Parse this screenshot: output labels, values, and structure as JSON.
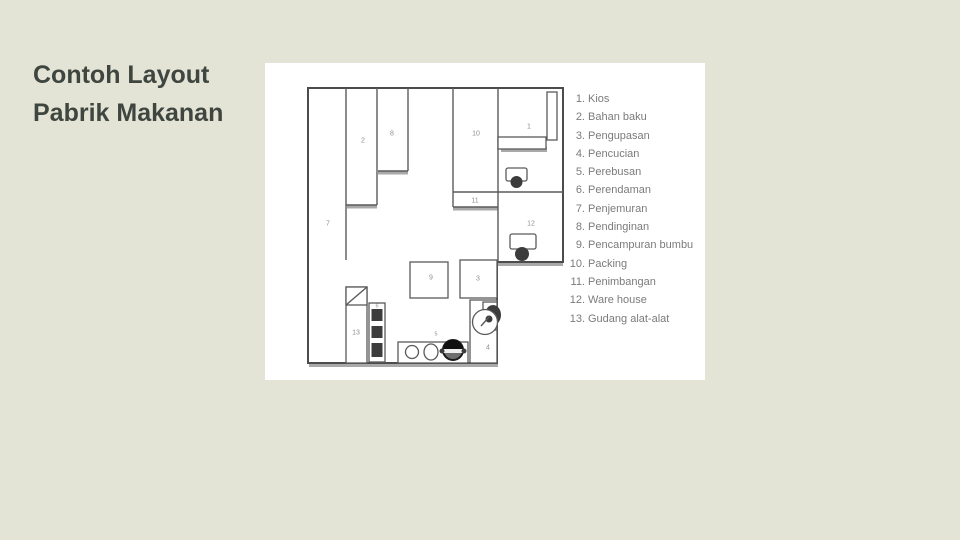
{
  "slide": {
    "title_line1": "Contoh Layout",
    "title_line2": "Pabrik Makanan"
  },
  "colors": {
    "background": "#e3e4d6",
    "panel": "#ffffff",
    "title_text": "#3e463f",
    "wall": "#4c4c4c",
    "wall_shadow": "#a9a9a9",
    "legend_text": "#7b7b7b",
    "room_label": "#8f8f8f",
    "equipment_dark": "#3c3c3c"
  },
  "plan": {
    "rooms": [
      {
        "num": "1",
        "name": "Kios"
      },
      {
        "num": "2",
        "name": "Bahan baku"
      },
      {
        "num": "3",
        "name": "Pengupasan"
      },
      {
        "num": "4",
        "name": "Pencucian"
      },
      {
        "num": "5",
        "name": "Perebusan"
      },
      {
        "num": "6",
        "name": "Perendaman"
      },
      {
        "num": "7",
        "name": "Penjemuran"
      },
      {
        "num": "8",
        "name": "Pendinginan"
      },
      {
        "num": "9",
        "name": "Pencampuran bumbu"
      },
      {
        "num": "10",
        "name": "Packing"
      },
      {
        "num": "11",
        "name": "Penimbangan"
      },
      {
        "num": "12",
        "name": "Ware house"
      },
      {
        "num": "13",
        "name": "Gudang alat-alat"
      }
    ]
  },
  "legend": {
    "items": [
      {
        "num": "1.",
        "label": "Kios"
      },
      {
        "num": "2.",
        "label": "Bahan baku"
      },
      {
        "num": "3.",
        "label": "Pengupasan"
      },
      {
        "num": "4.",
        "label": "Pencucian"
      },
      {
        "num": "5.",
        "label": "Perebusan"
      },
      {
        "num": "6.",
        "label": "Perendaman"
      },
      {
        "num": "7.",
        "label": "Penjemuran"
      },
      {
        "num": "8.",
        "label": "Pendinginan"
      },
      {
        "num": "9.",
        "label": "Pencampuran bumbu"
      },
      {
        "num": "10.",
        "label": "Packing"
      },
      {
        "num": "11.",
        "label": "Penimbangan"
      },
      {
        "num": "12.",
        "label": "Ware house"
      },
      {
        "num": "13.",
        "label": "Gudang alat-alat"
      }
    ]
  }
}
